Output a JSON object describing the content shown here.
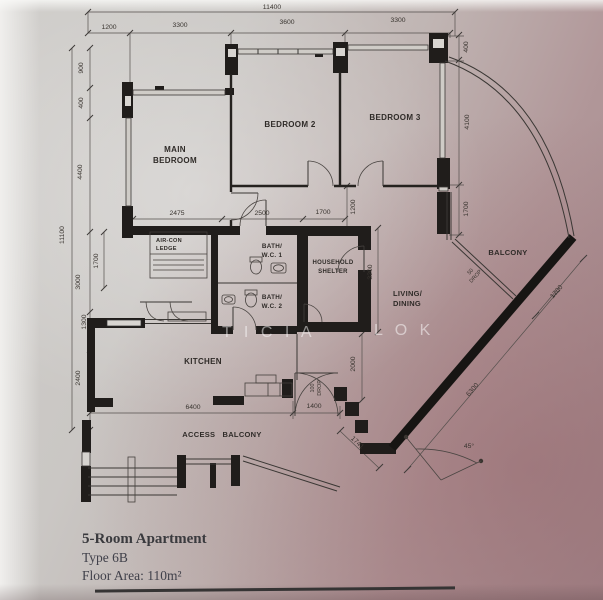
{
  "meta": {
    "plan_title": "5-Room Apartment",
    "plan_type": "Type 6B",
    "plan_area": "Floor Area: 110m²"
  },
  "watermark": {
    "part1": "T I C I A",
    "part2": "L O K"
  },
  "rooms": {
    "main_bedroom_l1": "MAIN",
    "main_bedroom_l2": "BEDROOM",
    "bedroom2": "BEDROOM 2",
    "bedroom3": "BEDROOM 3",
    "kitchen": "KITCHEN",
    "living_l1": "LIVING/",
    "living_l2": "DINING",
    "balcony": "BALCONY",
    "access_balcony": "ACCESS   BALCONY",
    "bath1_l1": "BATH/",
    "bath1_l2": "W.C. 1",
    "bath2_l1": "BATH/",
    "bath2_l2": "W.C. 2",
    "shelter_l1": "HOUSEHOLD",
    "shelter_l2": "SHELTER",
    "aircon_l1": "AIR-CON",
    "aircon_l2": "LEDGE"
  },
  "dims": {
    "top_overall": "11400",
    "top_a": "1200",
    "top_b": "3300",
    "top_c": "3600",
    "top_d": "3300",
    "left_overall": "11100",
    "left_a": "900",
    "left_b": "400",
    "left_c": "4400",
    "left_d": "1700",
    "left_e": "3000",
    "left_f": "1300",
    "left_g": "2400",
    "right_a": "400",
    "right_b": "4100",
    "right_c": "1700",
    "mid_a": "2475",
    "mid_b": "2500",
    "mid_c": "1700",
    "mid_d": "1200",
    "shelter": "3200",
    "living": "2000",
    "kitchen": "6400",
    "entrance": "1400",
    "drop_entrance_l1": "100",
    "drop_entrance_l2": "DROP",
    "drop_balcony_l1": "50",
    "drop_balcony_l2": "DROP",
    "diag_a": "1741",
    "diag_b": "6300",
    "diag_c": "1700",
    "angle": "45°"
  }
}
